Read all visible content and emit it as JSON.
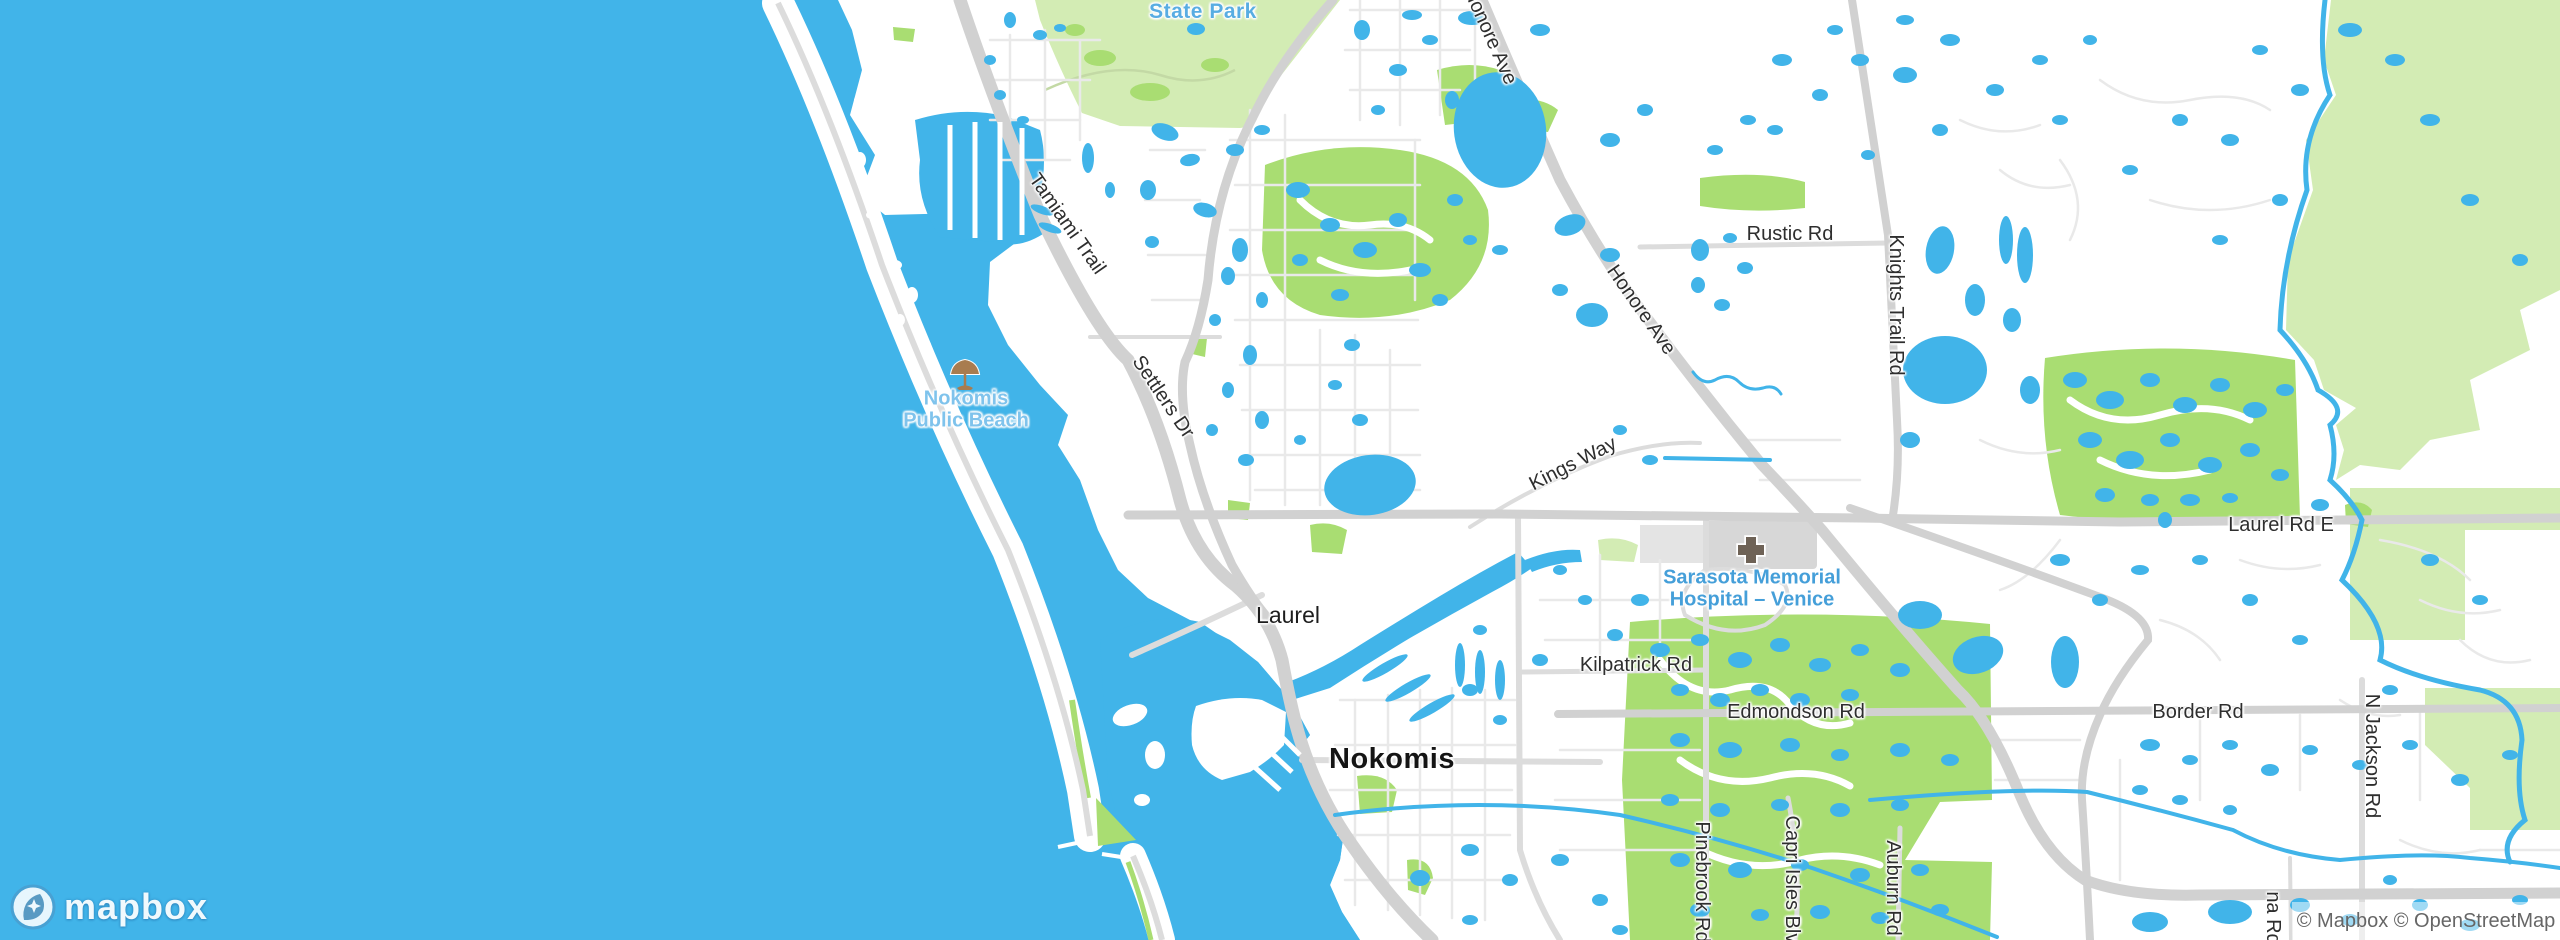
{
  "map": {
    "attribution": "© Mapbox © OpenStreetMap",
    "logo_word": "mapbox",
    "colors": {
      "water": "#41b4e9",
      "land": "#ffffff",
      "park_pale": "#d3ecb4",
      "park_bright": "#a9dd72",
      "road_major": "#d1d1d1",
      "road_minor": "#e9e9e9",
      "poi_blue": "#459fd9",
      "building_gray": "#d7d7d7"
    },
    "places": {
      "nokomis": "Nokomis",
      "laurel": "Laurel"
    },
    "pois": {
      "state_park": "State Park",
      "beach_line1": "Nokomis",
      "beach_line2": "Public Beach",
      "hospital_line1": "Sarasota Memorial",
      "hospital_line2": "Hospital – Venice"
    },
    "roads": {
      "tamiami": "Tamiami Trail",
      "settlers": "Settlers Dr",
      "honore_top": "Honore Ave",
      "honore_mid": "Honore Ave",
      "rustic": "Rustic Rd",
      "knights": "Knights Trail Rd",
      "kings": "Kings Way",
      "laurel_rd_e": "Laurel Rd E",
      "kilpatrick": "Kilpatrick Rd",
      "edmondson": "Edmondson Rd",
      "border": "Border Rd",
      "jackson": "N Jackson Rd",
      "pinebrook": "Pinebrook Rd",
      "capri": "Capri Isles Blvd",
      "auburn": "Auburn Rd",
      "na_rd": "na Rd"
    }
  }
}
